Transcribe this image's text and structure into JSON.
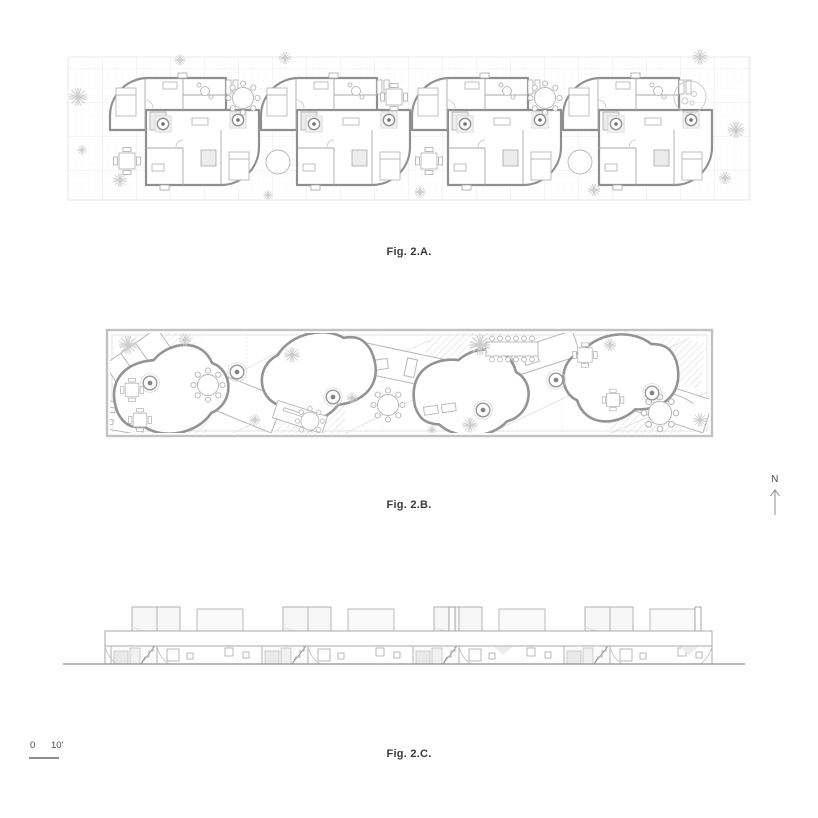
{
  "sheet": {
    "background": "#ffffff"
  },
  "figures": [
    {
      "id": "fig-2a",
      "label": "Fig. 2.A."
    },
    {
      "id": "fig-2b",
      "label": "Fig. 2.B."
    },
    {
      "id": "fig-2c",
      "label": "Fig. 2.C."
    }
  ],
  "north_indicator": {
    "label": "N"
  },
  "scale_bar": {
    "zero_label": "0",
    "ten_label": "10'"
  },
  "colors": {
    "wall_line": "#8f8f8f",
    "furniture_line": "#b5b5b5",
    "grid_line": "#ebebeb",
    "grid_major_line": "#dedede",
    "hatch_fill": "#e2e2e2",
    "panel_fill": "#ececec",
    "roof_fill": "#f6f6f6",
    "figure_label_text": "#3a3a3a",
    "annotation_text": "#4a4a4a"
  }
}
